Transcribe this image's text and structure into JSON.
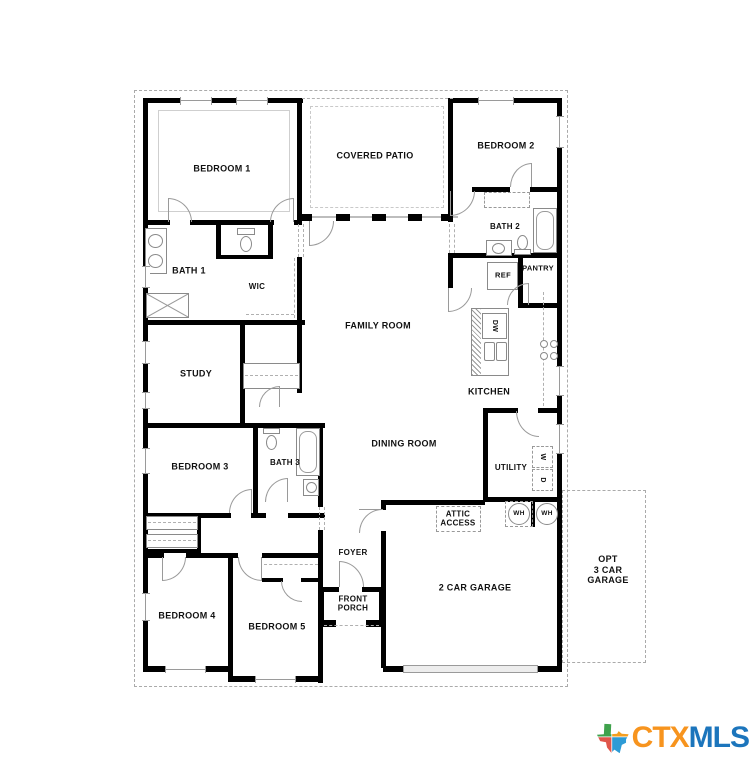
{
  "rooms": {
    "bedroom1": "BEDROOM 1",
    "covered_patio": "COVERED PATIO",
    "bedroom2": "BEDROOM 2",
    "bath1": "BATH 1",
    "bath2": "BATH 2",
    "wic": "WIC",
    "ref": "REF",
    "pantry": "PANTRY",
    "family_room": "FAMILY ROOM",
    "study": "STUDY",
    "dishwasher": "DW",
    "kitchen": "KITCHEN",
    "dining_room": "DINING ROOM",
    "bedroom3": "BEDROOM 3",
    "bath3": "BATH 3",
    "utility": "UTILITY",
    "washer": "W",
    "dryer": "D",
    "attic_access_line1": "ATTIC",
    "attic_access_line2": "ACCESS",
    "water_heater_1": "WH",
    "water_heater_2": "WH",
    "foyer": "FOYER",
    "front_porch_line1": "FRONT",
    "front_porch_line2": "PORCH",
    "bedroom4": "BEDROOM 4",
    "bedroom5": "BEDROOM 5",
    "garage": "2 CAR GARAGE",
    "opt_garage_line1": "OPT",
    "opt_garage_line2": "3 CAR",
    "opt_garage_line3": "GARAGE"
  },
  "logo": {
    "ctx": "CTX",
    "mls": "MLS",
    "colors": {
      "ctx_text": "#F7941E",
      "mls_text": "#1C75BC",
      "texas_green": "#3FA24C",
      "texas_orange": "#F59E1F",
      "texas_red": "#E0564A",
      "texas_blue": "#2D9BD6"
    }
  }
}
